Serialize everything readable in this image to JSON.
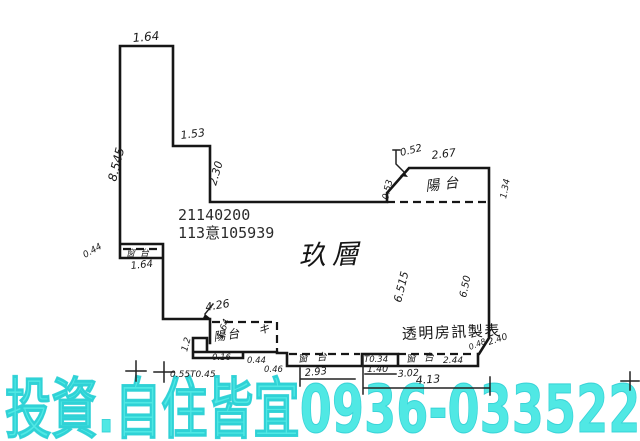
{
  "plan": {
    "permit_number": "21140200",
    "case_number": "113意105939",
    "floor_label": "玖層",
    "maker_label": "透明房訊製表",
    "balcony_top": "陽台",
    "balcony_bottom": "陽台",
    "window_sill_left": "窗台",
    "window_sill_mid": "窗台",
    "window_sill_right": "窗台",
    "hand_mark": "キ",
    "dims": {
      "top_width": "1.64",
      "left_height": "8.545",
      "step_width": "1.53",
      "step_height": "2.30",
      "balcony_chamfer": "0.52",
      "balcony_width": "2.67",
      "balcony_left": "0.53",
      "balcony_right": "1.34",
      "interior_height": "6.515",
      "right_height": "6.50",
      "left_window_depth": "0.44",
      "left_window_width": "1.64",
      "low_balcony_width": "4.26",
      "low_balcony_side": "1.64",
      "low_balcony_notch": "1.2",
      "sill_depth": "0.16",
      "low_left_dims": "0.55T0.45",
      "low_mid_a": "0.44",
      "low_mid_b": "0.46",
      "window_mid_width": "2.93",
      "pillar_width": "T0.34",
      "pillar_span": "1.40",
      "window_right_sill": "2.44",
      "window_right_span": "3.02",
      "bottom_total": "4.13",
      "corner_a": "0.48",
      "corner_b": "2.40"
    }
  },
  "banner": {
    "text": "投資.自住皆宜0936-033522",
    "color": "#50e8e4"
  }
}
